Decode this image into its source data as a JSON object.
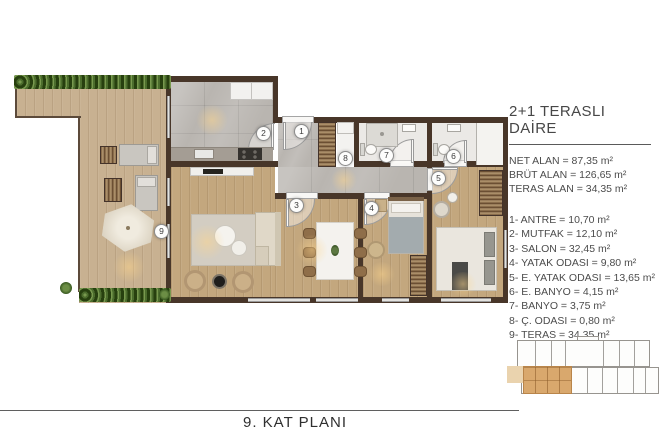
{
  "info_panel": {
    "title": "2+1 TERASLI DAİRE",
    "areas": [
      "NET ALAN = 87,35 m²",
      "BRÜT ALAN = 126,65 m²",
      "TERAS ALAN = 34,35 m²"
    ],
    "rooms": [
      "1- ANTRE = 10,70 m²",
      "2- MUTFAK = 12,10 m²",
      "3- SALON = 32,45 m²",
      "4- YATAK ODASI = 9,80 m²",
      "5- E. YATAK ODASI = 13,65 m²",
      "6- E. BANYO = 4,15 m²",
      "7- BANYO = 3,75 m²",
      "8- Ç. ODASI = 0,80 m²",
      "9- TERAS = 34,35 m²"
    ]
  },
  "plan": {
    "room_labels": [
      "1",
      "2",
      "3",
      "4",
      "5",
      "6",
      "7",
      "8",
      "9"
    ]
  },
  "footer": {
    "caption": "9. KAT PLANI"
  },
  "colors": {
    "wall": "#483629",
    "terrace_wood": "#c8b191",
    "room_wood": "#c3a77e",
    "tile_gray": "#b9b5b0",
    "bath_floor": "#ebe9e6",
    "hedge_green": "#2f4b19",
    "keyplan_highlight": "#d9a86d",
    "text": "#4c4c4c"
  }
}
